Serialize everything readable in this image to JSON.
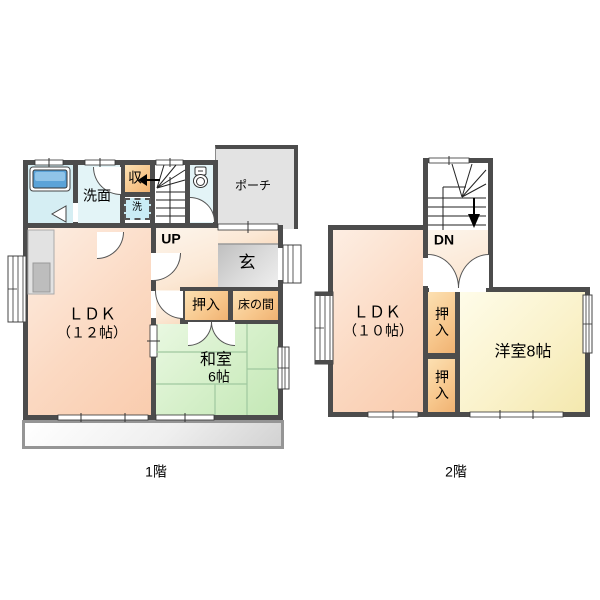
{
  "floor1": {
    "label": "1階",
    "ldk": "ＬＤＫ",
    "ldk_size": "（１２帖）",
    "washitsu": "和室",
    "washitsu_size": "6帖",
    "oshiire": "押入",
    "tokonoma": "床の間",
    "genkan": "玄",
    "porch": "ポーチ",
    "senmen": "洗面",
    "storage": "収",
    "washer": "洗",
    "stairs_dir": "UP"
  },
  "floor2": {
    "label": "2階",
    "ldk": "ＬＤＫ",
    "ldk_size": "（１０帖）",
    "yoshitsu": "洋室8帖",
    "oshiire_top": "押入",
    "oshiire_bottom": "押入",
    "stairs_dir": "DN"
  },
  "colors": {
    "wall": "#4c4c4c",
    "ldk_fill": "#fbd6bd",
    "washitsu_fill": "#cfecc2",
    "yoshitsu_fill": "#f7eebc",
    "closet_fill": "#f5c081",
    "genkan_fill": "#d0d0d0",
    "bath_fill": "#d5eef3",
    "tub_fill": "#5ba3d8",
    "tatami_line": "#9fc89f"
  }
}
